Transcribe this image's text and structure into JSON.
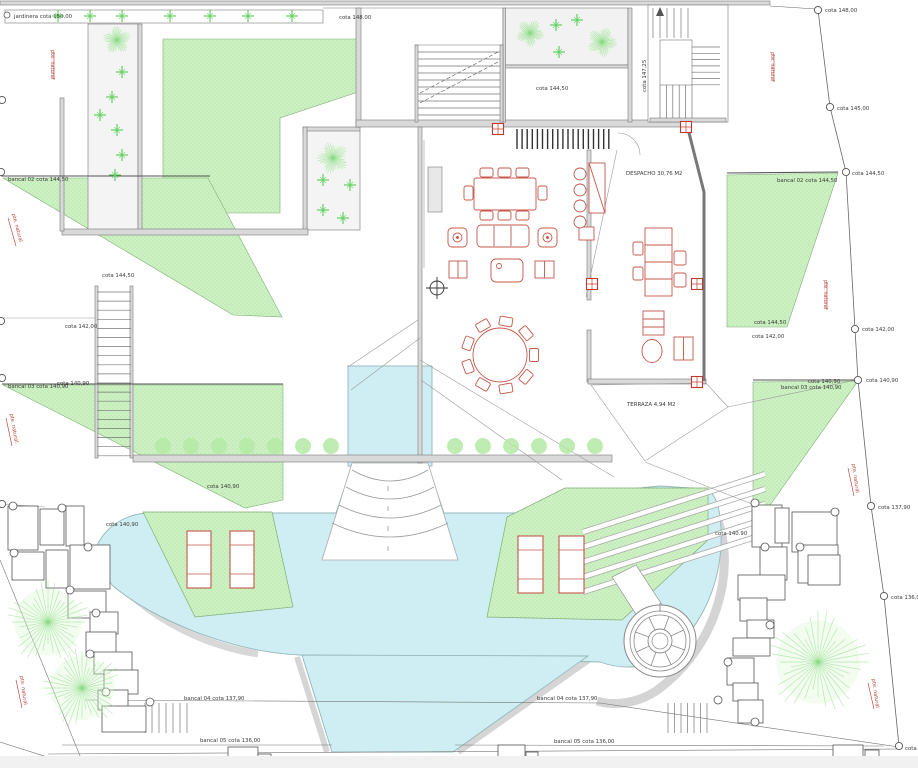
{
  "labels": {
    "jardinera": "jardinera cota 150,00",
    "cota14800_a": "cota 148.00",
    "cota14800_b": "cota 148,00",
    "cota14500": "cota 145,00",
    "cota14725": "cota 147,25",
    "cota14450_mid": "cota 144,50",
    "bancal02": "bancal 02 cota 144,50",
    "cota14450": "cota 144,50",
    "cota14200": "cota 142,00",
    "bancal03": "bancal 03 cota 140,90",
    "cota14090": "cota 140,90",
    "cota14090_dot": "cota 140.90",
    "cota13790": "cota 137,90",
    "cota13600": "cota 136,00",
    "bancal04": "bancal 04 cota 137,90",
    "bancal05": "bancal 05 cota 136,00",
    "despacho": "DESPACHO 30,76 M2",
    "terraza": "TERRAZA 4,94 M2",
    "pte": "pte. natural",
    "cota_cut": "cota"
  },
  "colors": {
    "pool": "#cfeef4",
    "lawn": "#cdf1c3",
    "furniture": "#c4574a",
    "marker_red": "#c0392b"
  }
}
